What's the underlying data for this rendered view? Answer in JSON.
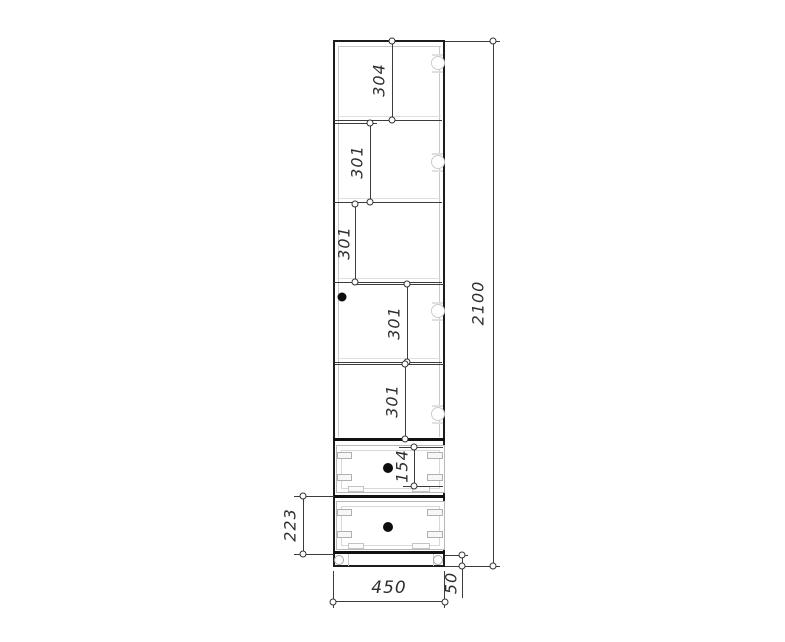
{
  "drawing": {
    "dims": {
      "shelf1": "304",
      "shelf2": "301",
      "shelf3": "301",
      "shelf4": "301",
      "shelf5": "301",
      "drawer1": "154",
      "drawer2": "223",
      "total_height": "2100",
      "width": "450",
      "plinth": "50"
    },
    "colors": {
      "outline": "#1c1c1c",
      "dimension_line": "#3c3c3c",
      "light_line": "#c9c9c9",
      "label_text": "#2e2e2e",
      "background": "#ffffff"
    }
  }
}
